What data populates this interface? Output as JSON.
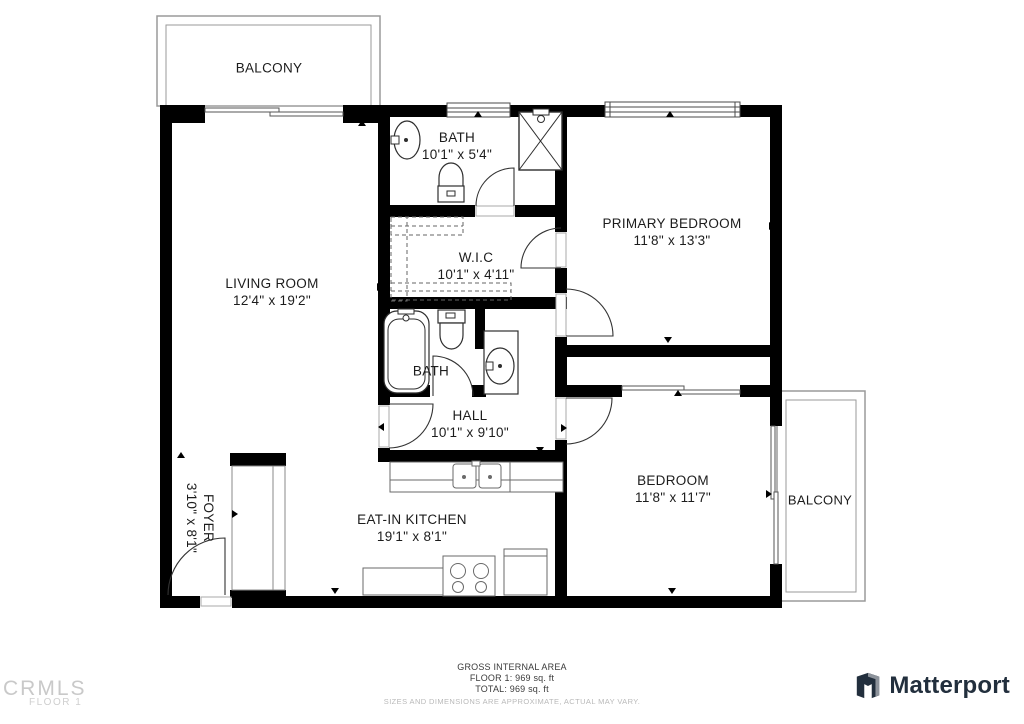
{
  "plan": {
    "rooms": {
      "balcony_top": {
        "label": "BALCONY"
      },
      "living_room": {
        "label": "LIVING ROOM",
        "dims": "12'4\" x 19'2\""
      },
      "bath_top": {
        "label": "BATH",
        "dims": "10'1\" x 5'4\""
      },
      "primary_bedroom": {
        "label": "PRIMARY BEDROOM",
        "dims": "11'8\" x 13'3\""
      },
      "wic": {
        "label": "W.I.C",
        "dims": "10'1\" x 4'11\""
      },
      "bath_hall": {
        "label": "BATH"
      },
      "hall": {
        "label": "HALL",
        "dims": "10'1\" x 9'10\""
      },
      "foyer": {
        "label": "FOYER",
        "dims": "3'10\" x 8'1\""
      },
      "kitchen": {
        "label": "EAT-IN KITCHEN",
        "dims": "19'1\" x 8'1\""
      },
      "bedroom": {
        "label": "BEDROOM",
        "dims": "11'8\" x 11'7\""
      },
      "balcony_right": {
        "label": "BALCONY"
      }
    }
  },
  "footer": {
    "area_title": "GROSS INTERNAL AREA",
    "floor_line": "FLOOR 1: 969 sq. ft",
    "total_line": "TOTAL: 969 sq. ft",
    "disclaimer": "SIZES AND DIMENSIONS ARE APPROXIMATE, ACTUAL MAY VARY."
  },
  "branding": {
    "mls_name": "CRMLS",
    "mls_floor": "FLOOR 1",
    "provider": "Matterport"
  },
  "colors": {
    "wall": "#000000",
    "fixture_line": "#2e2e2e",
    "balcony_line": "#9a9a9a",
    "label_text": "#1c1c1c",
    "footer_text": "#3a3a3a",
    "disclaimer_text": "#b9b9b9",
    "brand_dark": "#222f3d",
    "mls_gray": "#c9c9c9"
  }
}
